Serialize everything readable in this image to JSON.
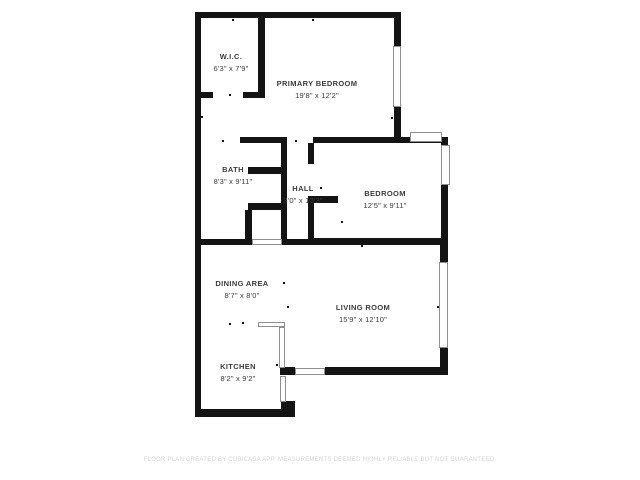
{
  "page": {
    "footer": "FLOOR PLAN CREATED BY CUBICASA APP. MEASUREMENTS DEEMED HIGHLY RELIABLE BUT NOT GUARANTEED."
  },
  "colors": {
    "wall": "#141414",
    "label_text": "#3c3c3c",
    "window_border": "#8f8f8f",
    "footer_text": "#d4d4d4",
    "background": "#ffffff"
  },
  "rooms": [
    {
      "name": "W.I.C.",
      "dims": "6'3\" x 7'9\"",
      "cx": 231,
      "y": 52
    },
    {
      "name": "PRIMARY BEDROOM",
      "dims": "19'8\" x 12'2\"",
      "cx": 317,
      "y": 79
    },
    {
      "name": "BATH",
      "dims": "8'3\" x 9'11\"",
      "cx": 233,
      "y": 165
    },
    {
      "name": "HALL",
      "dims": "3'0\" x 10'3\"",
      "cx": 303,
      "y": 184
    },
    {
      "name": "BEDROOM",
      "dims": "12'5\" x 9'11\"",
      "cx": 385,
      "y": 189
    },
    {
      "name": "DINING AREA",
      "dims": "8'7\" x 8'0\"",
      "cx": 242,
      "y": 279
    },
    {
      "name": "LIVING ROOM",
      "dims": "15'9\" x 12'10\"",
      "cx": 363,
      "y": 303
    },
    {
      "name": "KITCHEN",
      "dims": "8'2\" x 9'2\"",
      "cx": 238,
      "y": 362
    }
  ],
  "plan": {
    "walls": [
      [
        195,
        12,
        206,
        6
      ],
      [
        195,
        12,
        6,
        405
      ],
      [
        394,
        12,
        7,
        34
      ],
      [
        394,
        107,
        7,
        36
      ],
      [
        258,
        12,
        7,
        86
      ],
      [
        195,
        92,
        18,
        6
      ],
      [
        243,
        92,
        22,
        6
      ],
      [
        240,
        137,
        47,
        6
      ],
      [
        313,
        137,
        135,
        6
      ],
      [
        441,
        137,
        7,
        108
      ],
      [
        281,
        137,
        6,
        73
      ],
      [
        248,
        167,
        39,
        7
      ],
      [
        248,
        203,
        39,
        7
      ],
      [
        245,
        210,
        7,
        35
      ],
      [
        281,
        210,
        6,
        29
      ],
      [
        308,
        143,
        6,
        21
      ],
      [
        308,
        196,
        6,
        49
      ],
      [
        308,
        196,
        30,
        7
      ],
      [
        195,
        239,
        57,
        6
      ],
      [
        282,
        239,
        31,
        6
      ],
      [
        313,
        238,
        135,
        7
      ],
      [
        440,
        238,
        8,
        26
      ],
      [
        440,
        348,
        8,
        27
      ],
      [
        325,
        367,
        123,
        8
      ],
      [
        280,
        367,
        15,
        8
      ],
      [
        195,
        409,
        100,
        8
      ],
      [
        281,
        401,
        14,
        16
      ]
    ],
    "windows": [
      [
        393,
        46,
        8,
        61
      ],
      [
        410,
        132,
        32,
        10
      ],
      [
        441,
        145,
        9,
        40
      ],
      [
        439,
        262,
        9,
        86
      ],
      [
        295,
        368,
        30,
        7
      ],
      [
        252,
        239,
        30,
        6
      ],
      [
        258,
        322,
        27,
        5
      ],
      [
        279,
        327,
        6,
        41
      ],
      [
        280,
        376,
        6,
        26
      ]
    ],
    "dots": [
      [
        232,
        19
      ],
      [
        312,
        19
      ],
      [
        201,
        116
      ],
      [
        229,
        94
      ],
      [
        222,
        140
      ],
      [
        295,
        140
      ],
      [
        285,
        187
      ],
      [
        320,
        187
      ],
      [
        341,
        221
      ],
      [
        361,
        245
      ],
      [
        283,
        282
      ],
      [
        287,
        306
      ],
      [
        437,
        306
      ],
      [
        229,
        323
      ],
      [
        242,
        322
      ],
      [
        276,
        364
      ],
      [
        391,
        117
      ]
    ]
  }
}
